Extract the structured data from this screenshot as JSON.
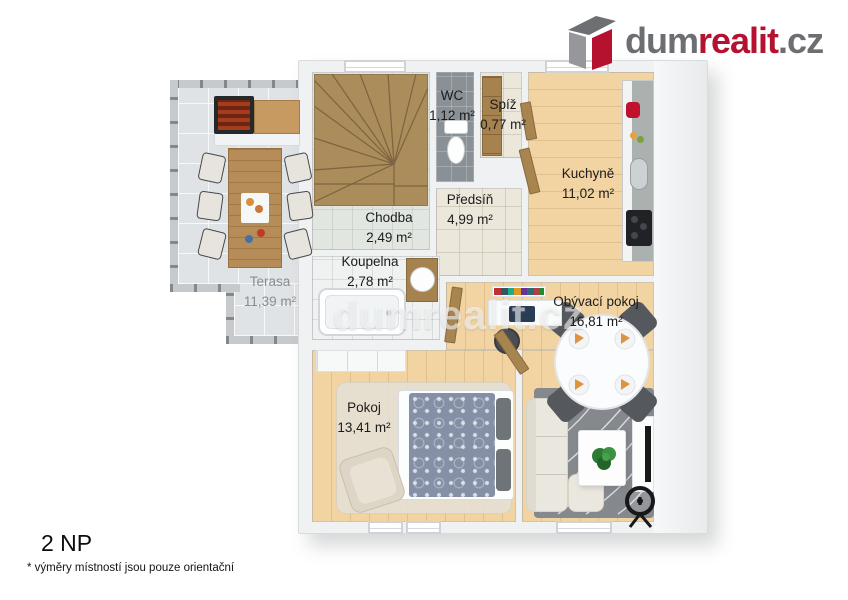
{
  "logo": {
    "part1": "dum",
    "part2": "realit",
    "part3": ".cz",
    "gray": "#6d6e71",
    "red": "#b5122f"
  },
  "watermark": "dumrealit.cz",
  "meta": {
    "floor": "2 NP",
    "footnote": "* výměry místností jsou pouze orientační"
  },
  "rooms": {
    "wc": {
      "name": "WC",
      "area": "1,12 m²"
    },
    "spiz": {
      "name": "Spíž",
      "area": "0,77 m²"
    },
    "kuchyne": {
      "name": "Kuchyně",
      "area": "11,02 m²"
    },
    "predsin": {
      "name": "Předsíň",
      "area": "4,99 m²"
    },
    "chodba": {
      "name": "Chodba",
      "area": "2,49 m²"
    },
    "koupelna": {
      "name": "Koupelna",
      "area": "2,78 m²"
    },
    "obyvaci_pokoj": {
      "name": "Obývací pokoj",
      "area": "16,81 m²"
    },
    "pokoj": {
      "name": "Pokoj",
      "area": "13,41 m²"
    },
    "terasa": {
      "name": "Terasa",
      "area": "11,39 m²"
    }
  }
}
